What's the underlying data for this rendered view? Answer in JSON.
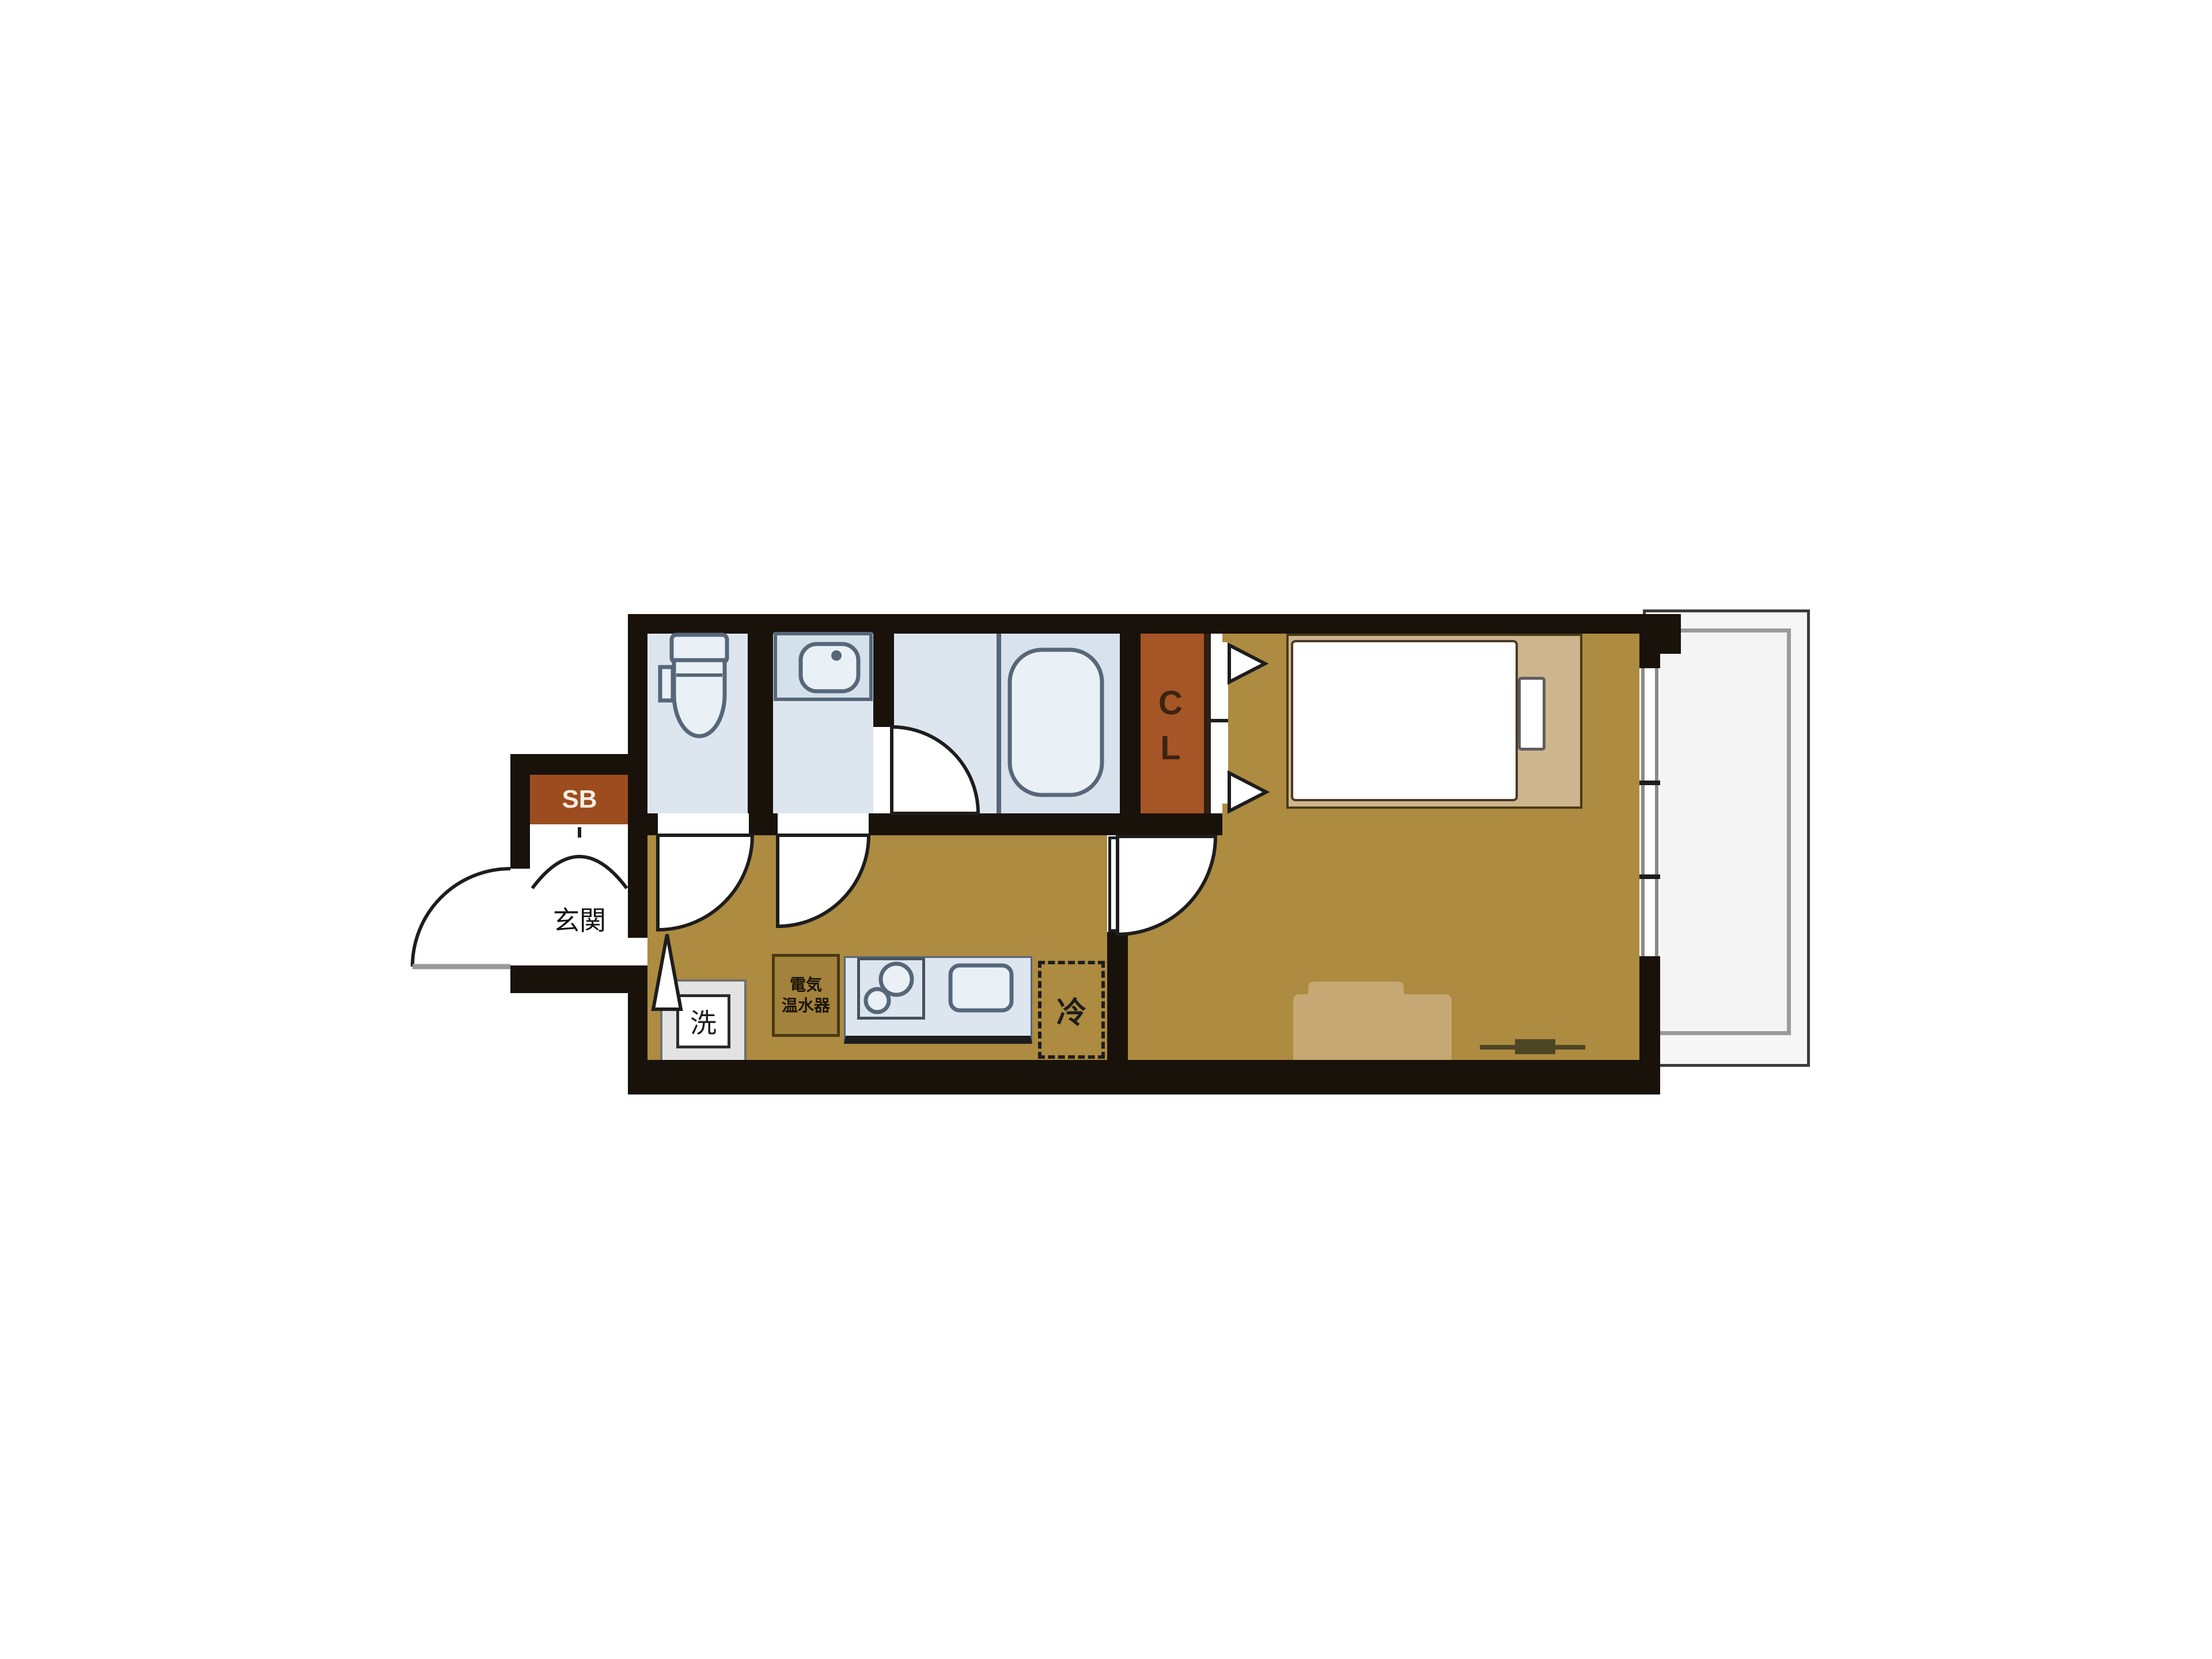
{
  "plan": {
    "type": "japanese-apartment-floor-plan",
    "labels": {
      "shoe_box": "SB",
      "entrance": "玄関",
      "closet_line1": "C",
      "closet_line2": "L",
      "washer": "洗",
      "fridge": "冷",
      "water_heater_line1": "電気",
      "water_heater_line2": "温水器"
    },
    "icons": [
      "toilet-icon",
      "washbasin-icon",
      "bathtub-icon",
      "door-swing-arc-icon",
      "entrance-door-arc-icon",
      "closet-folding-door-icon",
      "step-up-triangle-icon",
      "entrance-step-curve-icon",
      "bed-icon",
      "pillow-icon",
      "sofa-icon",
      "stove-burners-icon",
      "kitchen-sink-icon",
      "refrigerator-dashed-box-icon",
      "washing-machine-icon",
      "sliding-window-icon",
      "balcony-railing-icon",
      "floor-socket-marker-icon"
    ]
  },
  "colors": {
    "wall": "#19120a",
    "line": "#1d1d1d",
    "floor": "#ad8b40",
    "wet": "#dde6ee",
    "wetdark": "#d8e2ec",
    "fixture": "#e9f0f6",
    "stroke": "#56677a",
    "rust": "#9d4c20",
    "rustcl": "#a65526",
    "cltext": "#3a2412",
    "platform": "#cdb58d",
    "platformline": "#4b3a17",
    "sofa": "#c5a873",
    "balcony": "#f6f6f6",
    "rail": "#9b9b9b",
    "heaterbox": "#a2823c",
    "heaterline": "#4a3a14",
    "heatertext": "#1c1406",
    "marker": "#4c4526",
    "sbtext": "#f5ede2"
  }
}
